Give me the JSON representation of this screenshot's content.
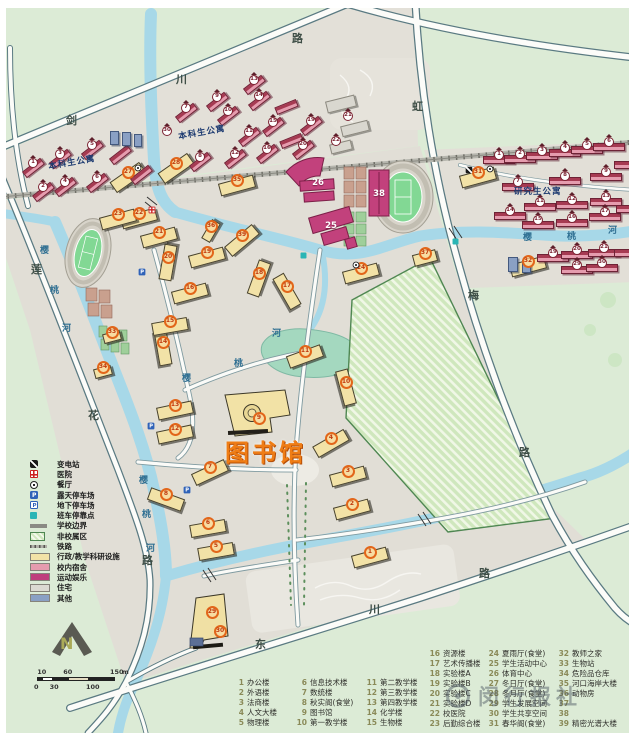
{
  "labels": {
    "library": "图书馆",
    "area_labels": [
      {
        "text": "本科生公寓",
        "x": 48,
        "y": 156,
        "rot": -10
      },
      {
        "text": "本科生公寓",
        "x": 178,
        "y": 126,
        "rot": -10
      },
      {
        "text": "研究生公寓",
        "x": 514,
        "y": 185,
        "rot": 0
      }
    ],
    "road_labels": [
      {
        "ch": "剑",
        "x": 66,
        "y": 112
      },
      {
        "ch": "川",
        "x": 176,
        "y": 71
      },
      {
        "ch": "路",
        "x": 292,
        "y": 30
      },
      {
        "ch": "虹",
        "x": 412,
        "y": 98
      },
      {
        "ch": "梅",
        "x": 468,
        "y": 287
      },
      {
        "ch": "路",
        "x": 519,
        "y": 444
      },
      {
        "ch": "莲",
        "x": 31,
        "y": 261
      },
      {
        "ch": "花",
        "x": 88,
        "y": 407
      },
      {
        "ch": "路",
        "x": 142,
        "y": 552
      },
      {
        "ch": "东",
        "x": 255,
        "y": 636
      },
      {
        "ch": "川",
        "x": 369,
        "y": 601
      },
      {
        "ch": "路",
        "x": 479,
        "y": 565
      }
    ],
    "river_labels": [
      {
        "ch": "樱",
        "x": 523,
        "y": 230
      },
      {
        "ch": "桃",
        "x": 567,
        "y": 229
      },
      {
        "ch": "河",
        "x": 608,
        "y": 223
      },
      {
        "ch": "河",
        "x": 272,
        "y": 326
      },
      {
        "ch": "桃",
        "x": 234,
        "y": 356
      },
      {
        "ch": "樱",
        "x": 182,
        "y": 371
      },
      {
        "ch": "樱",
        "x": 40,
        "y": 243
      },
      {
        "ch": "桃",
        "x": 50,
        "y": 283
      },
      {
        "ch": "河",
        "x": 62,
        "y": 321
      },
      {
        "ch": "樱",
        "x": 139,
        "y": 473
      },
      {
        "ch": "桃",
        "x": 142,
        "y": 507
      },
      {
        "ch": "河",
        "x": 146,
        "y": 541
      }
    ]
  },
  "map": {
    "badges_academic": [
      {
        "n": 1,
        "x": 370,
        "y": 552
      },
      {
        "n": 2,
        "x": 352,
        "y": 504
      },
      {
        "n": 3,
        "x": 348,
        "y": 471
      },
      {
        "n": 4,
        "x": 331,
        "y": 438,
        "r": -30
      },
      {
        "n": 5,
        "x": 216,
        "y": 546,
        "r": -10
      },
      {
        "n": 6,
        "x": 208,
        "y": 523,
        "r": -10
      },
      {
        "n": 7,
        "x": 210,
        "y": 467,
        "r": -25
      },
      {
        "n": 8,
        "x": 166,
        "y": 494,
        "r": 20
      },
      {
        "n": 9,
        "x": 259,
        "y": 418
      },
      {
        "n": 10,
        "x": 346,
        "y": 382,
        "r": 75
      },
      {
        "n": 11,
        "x": 305,
        "y": 351,
        "r": -20
      },
      {
        "n": 12,
        "x": 175,
        "y": 429,
        "r": -12
      },
      {
        "n": 13,
        "x": 175,
        "y": 405,
        "r": -12
      },
      {
        "n": 14,
        "x": 163,
        "y": 342,
        "r": 80
      },
      {
        "n": 15,
        "x": 170,
        "y": 321,
        "r": -10
      },
      {
        "n": 16,
        "x": 190,
        "y": 288,
        "r": -15
      },
      {
        "n": 17,
        "x": 287,
        "y": 286,
        "r": 60
      },
      {
        "n": 18,
        "x": 259,
        "y": 273,
        "r": -70
      },
      {
        "n": 19,
        "x": 207,
        "y": 252
      },
      {
        "n": 20,
        "x": 168,
        "y": 257,
        "r": -80
      },
      {
        "n": 21,
        "x": 159,
        "y": 232
      },
      {
        "n": 22,
        "x": 139,
        "y": 213
      },
      {
        "n": 23,
        "x": 118,
        "y": 214
      },
      {
        "n": 24,
        "x": 361,
        "y": 268
      },
      {
        "n": 27,
        "x": 128,
        "y": 172,
        "r": -35
      },
      {
        "n": 28,
        "x": 176,
        "y": 163,
        "r": -35
      },
      {
        "n": 29,
        "x": 212,
        "y": 612
      },
      {
        "n": 30,
        "x": 220,
        "y": 631
      },
      {
        "n": 31,
        "x": 478,
        "y": 172
      },
      {
        "n": 32,
        "x": 528,
        "y": 261
      },
      {
        "n": 33,
        "x": 112,
        "y": 332,
        "w": 18,
        "h": 10
      },
      {
        "n": 34,
        "x": 103,
        "y": 367,
        "w": 18,
        "h": 10
      },
      {
        "n": 35,
        "x": 237,
        "y": 180
      },
      {
        "n": 36,
        "x": 211,
        "y": 226,
        "r": -60,
        "w": 22,
        "h": 10
      },
      {
        "n": 37,
        "x": 425,
        "y": 253,
        "w": 24,
        "h": 12
      },
      {
        "n": 39,
        "x": 242,
        "y": 235,
        "r": -40
      }
    ],
    "badges_dorm": [
      {
        "n": 1,
        "x": 33,
        "y": 163
      },
      {
        "n": 2,
        "x": 43,
        "y": 187
      },
      {
        "n": 3,
        "x": 60,
        "y": 154
      },
      {
        "n": 4,
        "x": 65,
        "y": 182
      },
      {
        "n": 5,
        "x": 92,
        "y": 145
      },
      {
        "n": 6,
        "x": 97,
        "y": 178
      },
      {
        "n": 7,
        "x": 186,
        "y": 108
      },
      {
        "n": 8,
        "x": 200,
        "y": 157
      },
      {
        "n": 9,
        "x": 217,
        "y": 97
      },
      {
        "n": 10,
        "x": 228,
        "y": 111
      },
      {
        "n": 11,
        "x": 249,
        "y": 132
      },
      {
        "n": 12,
        "x": 235,
        "y": 154
      },
      {
        "n": 13,
        "x": 254,
        "y": 80
      },
      {
        "n": 14,
        "x": 259,
        "y": 96
      },
      {
        "n": 15,
        "x": 273,
        "y": 122
      },
      {
        "n": 16,
        "x": 267,
        "y": 149
      },
      {
        "n": 19,
        "x": 311,
        "y": 121
      },
      {
        "n": 20,
        "x": 303,
        "y": 145
      },
      {
        "n": 30,
        "x": 167,
        "y": 131,
        "b": 0
      },
      {
        "n": 21,
        "x": 348,
        "y": 116,
        "b": 0
      },
      {
        "n": 22,
        "x": 336,
        "y": 141,
        "b": 0
      },
      {
        "n": 1,
        "x": 499,
        "y": 155,
        "g": 1
      },
      {
        "n": 2,
        "x": 520,
        "y": 154,
        "g": 1
      },
      {
        "n": 3,
        "x": 542,
        "y": 151,
        "g": 1
      },
      {
        "n": 4,
        "x": 565,
        "y": 148,
        "g": 1
      },
      {
        "n": 5,
        "x": 587,
        "y": 145,
        "g": 1
      },
      {
        "n": 6,
        "x": 609,
        "y": 142,
        "g": 1
      },
      {
        "n": 7,
        "x": 518,
        "y": 182,
        "g": 1
      },
      {
        "n": 8,
        "x": 565,
        "y": 176,
        "g": 1
      },
      {
        "n": 9,
        "x": 606,
        "y": 172,
        "g": 1
      },
      {
        "n": 11,
        "x": 540,
        "y": 202,
        "g": 1
      },
      {
        "n": 12,
        "x": 572,
        "y": 200,
        "g": 1
      },
      {
        "n": 13,
        "x": 606,
        "y": 197,
        "g": 1
      },
      {
        "n": 14,
        "x": 510,
        "y": 211,
        "g": 1
      },
      {
        "n": 15,
        "x": 538,
        "y": 220,
        "g": 1
      },
      {
        "n": 16,
        "x": 572,
        "y": 218,
        "g": 1
      },
      {
        "n": 17,
        "x": 605,
        "y": 212,
        "g": 1
      },
      {
        "n": 19,
        "x": 553,
        "y": 253,
        "g": 1
      },
      {
        "n": 20,
        "x": 577,
        "y": 250,
        "g": 1
      },
      {
        "n": 21,
        "x": 604,
        "y": 248,
        "g": 1
      },
      {
        "n": 29,
        "x": 577,
        "y": 265,
        "g": 1
      },
      {
        "n": 30,
        "x": 602,
        "y": 263,
        "g": 1
      }
    ],
    "badges_sport": [
      {
        "n": 26,
        "x": 318,
        "y": 183
      },
      {
        "n": 38,
        "x": 379,
        "y": 194
      },
      {
        "n": 25,
        "x": 331,
        "y": 226
      }
    ]
  },
  "legend": {
    "items": [
      {
        "icon": "substation",
        "label": "变电站"
      },
      {
        "icon": "hospital",
        "label": "医院"
      },
      {
        "icon": "restaurant",
        "label": "餐厅"
      },
      {
        "icon": "parking",
        "label": "露天停车场"
      },
      {
        "icon": "parking-u",
        "label": "地下停车场"
      },
      {
        "icon": "busstop",
        "label": "班车停靠点"
      },
      {
        "icon": "boundary",
        "label": "学校边界"
      },
      {
        "icon": "noncampus",
        "label": "非校属区"
      },
      {
        "icon": "railway",
        "label": "铁路"
      },
      {
        "icon": "swatch",
        "color": "#f2e2a7",
        "label": "行政/教学科研设施"
      },
      {
        "icon": "swatch",
        "color": "#e59cae",
        "label": "校内宿舍"
      },
      {
        "icon": "swatch",
        "color": "#bf3f7c",
        "label": "运动娱乐"
      },
      {
        "icon": "swatch",
        "color": "#dcdad2",
        "label": "住宅"
      },
      {
        "icon": "swatch",
        "color": "#8aa0c4",
        "label": "其他"
      }
    ]
  },
  "list": {
    "columns": [
      {
        "x": 231,
        "y": 677,
        "start": 1,
        "items": [
          "办公楼",
          "外语楼",
          "法商楼",
          "人文大楼",
          "物理楼"
        ]
      },
      {
        "x": 294,
        "y": 677,
        "start": 6,
        "items": [
          "信息技术楼",
          "数统楼",
          "秋实阁(食堂)",
          "图书馆",
          "第一教学楼"
        ]
      },
      {
        "x": 364,
        "y": 677,
        "start": 11,
        "items": [
          "第二教学楼",
          "第三教学楼",
          "第四教学楼",
          "化学楼",
          "生物楼"
        ]
      },
      {
        "x": 427,
        "y": 648,
        "start": 16,
        "items": [
          "资源楼",
          "艺术传播楼",
          "实验楼A",
          "实验楼B",
          "实验楼C",
          "实验楼D",
          "校医院",
          "后勤综合楼"
        ]
      },
      {
        "x": 486,
        "y": 648,
        "start": 24,
        "items": [
          "夏雨厅(食堂)",
          "学生活动中心",
          "体育中心",
          "冬日厅(食堂)",
          "冬月厅(食堂)",
          "学生发展空间",
          "学生共享空间",
          "春华阁(食堂)"
        ]
      },
      {
        "x": 556,
        "y": 648,
        "start": 32,
        "items": [
          "教师之家",
          "生物站",
          "危险品仓库",
          "河口海岸大楼",
          "动物房",
          "",
          "",
          "精密光谱大楼"
        ]
      }
    ]
  },
  "compass": {
    "label": "N"
  },
  "scale": {
    "max": 150,
    "top_ticks": [
      10,
      60,
      150
    ],
    "bottom_ticks": [
      0,
      30,
      100
    ],
    "unit": "m"
  },
  "watermark": {
    "text": "闵行报社"
  },
  "colors": {
    "academic": "#f2e2a7",
    "dormitory": "#e59cae",
    "sports": "#bf3f7c",
    "residential": "#dcdad2",
    "other": "#8aa0c4",
    "water": "#a7d8e8",
    "campus_ground": "#e1ded6",
    "outside_green": "#dcebd6",
    "badge_orange": "#e2661a",
    "highlight_text": "#ef7d15"
  }
}
